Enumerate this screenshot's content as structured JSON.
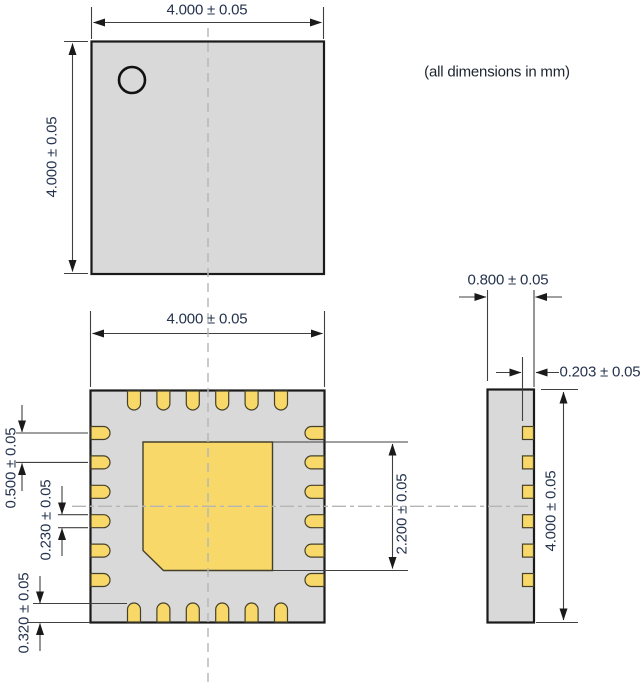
{
  "note": "(all dimensions in mm)",
  "colors": {
    "body_fill": "#d9d9d9",
    "pad_fill": "#f8d868",
    "pad_outline": "#45402a",
    "outline": "#1a1a1a",
    "dim_line": "#404040",
    "centerline": "#b5b5b5",
    "dim_text": "#25334e"
  },
  "top_view": {
    "width_dim": "4.000 ± 0.05",
    "height_dim": "4.000 ± 0.05"
  },
  "bottom_view": {
    "width_dim": "4.000 ± 0.05",
    "pad_pitch_dim": "0.500 ± 0.05",
    "pad_width_dim": "0.230 ± 0.05",
    "pad_length_dim": "0.320 ± 0.05",
    "center_pad_dim": "2.200 ± 0.05",
    "pads_per_side": 6,
    "total_pads": 24
  },
  "side_view": {
    "thickness_dim": "0.800 ± 0.05",
    "lead_thickness_dim": "0.203 ± 0.05",
    "height_dim": "4.000 ± 0.05"
  }
}
